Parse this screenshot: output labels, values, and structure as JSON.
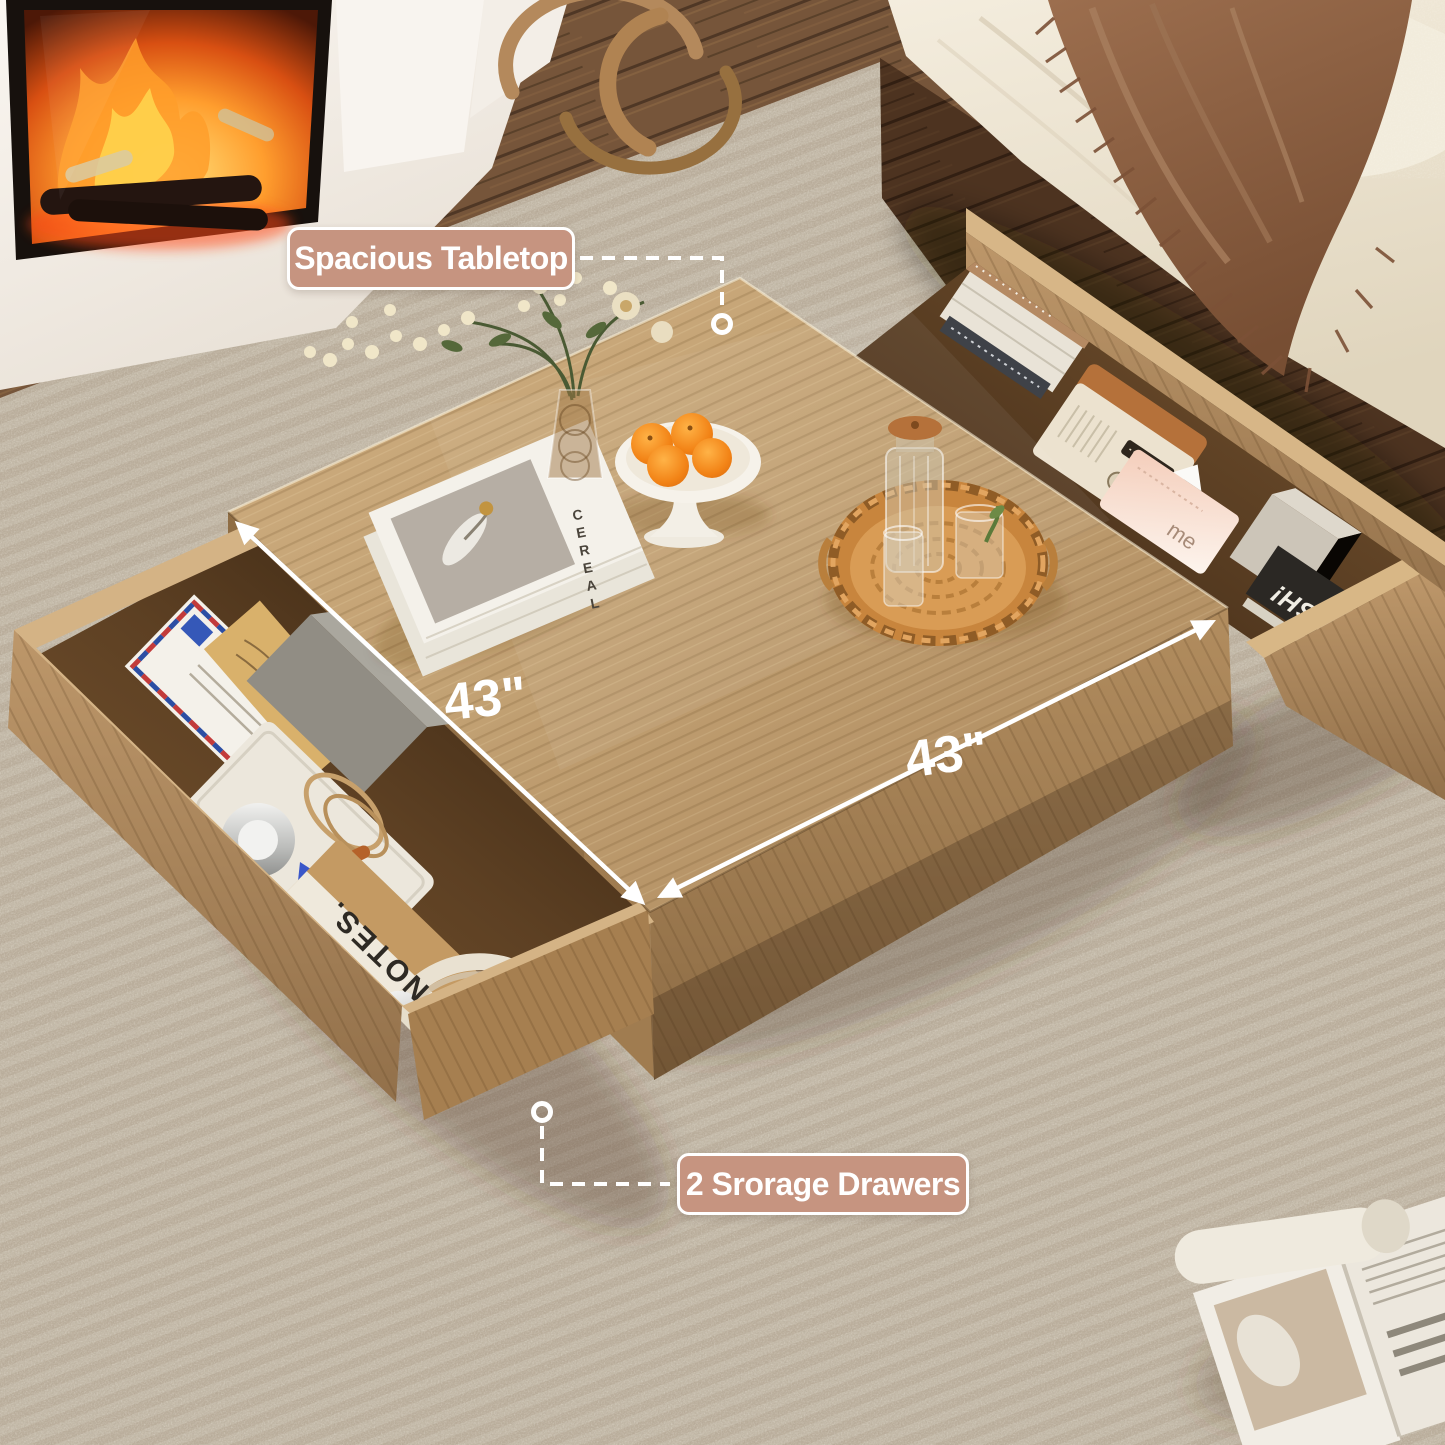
{
  "annotations": {
    "tabletop_label": "Spacious Tabletop",
    "drawers_label": "2 Srorage Drawers",
    "dim_left": "43\"",
    "dim_right": "43\""
  },
  "props": {
    "magazine_title": "CEREAL",
    "notebook_line1": "FIELD",
    "notebook_line2": "NOTES.",
    "tissue_text": "me",
    "drawer_magazine_text": "UNLEASH!"
  },
  "colors": {
    "label_bg": "#C69480",
    "label_border": "#FFFFFF",
    "label_text": "#FFFFFF",
    "annotation": "#FFFFFF",
    "tabletop_wood": "#C2A173",
    "drawer_wood": "#B28D5E",
    "carpet": "#C1B6A4",
    "walnut_floor": "#6B4930",
    "sofa_cream": "#F0E8D8",
    "throw_brown": "#8A5F43",
    "fire_orange": "#FF8C1F",
    "orange_fruit": "#F28316",
    "rattan": "#C8853D"
  }
}
